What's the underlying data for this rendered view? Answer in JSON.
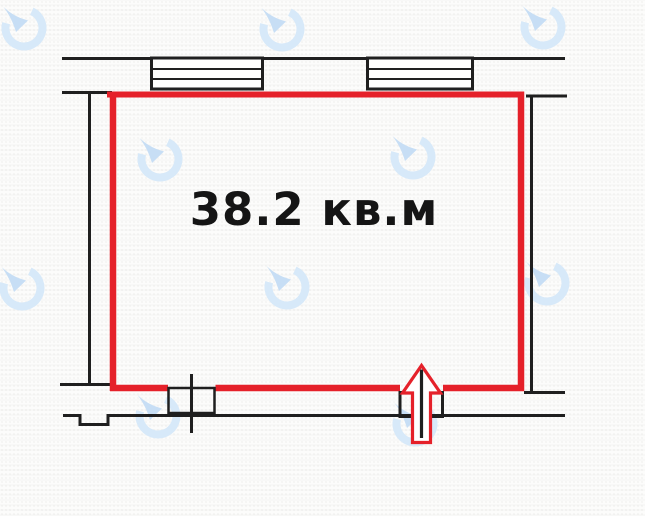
{
  "floor_plan": {
    "area_label": "38.2 кв.м",
    "room_area": {
      "value": 38.2,
      "unit": "кв.м"
    },
    "annotations": {
      "room_outline_color": "#e5212a",
      "entrance_marker": "red outlined up-arrow at bottom wall opening",
      "windows_visible": 2
    },
    "watermark": {
      "icon": "clock-circle-logo",
      "color": "#d7e9f9"
    },
    "colors": {
      "walls": "#1f1f1f",
      "background": "#fcfcfb",
      "label_text": "#151515"
    }
  }
}
